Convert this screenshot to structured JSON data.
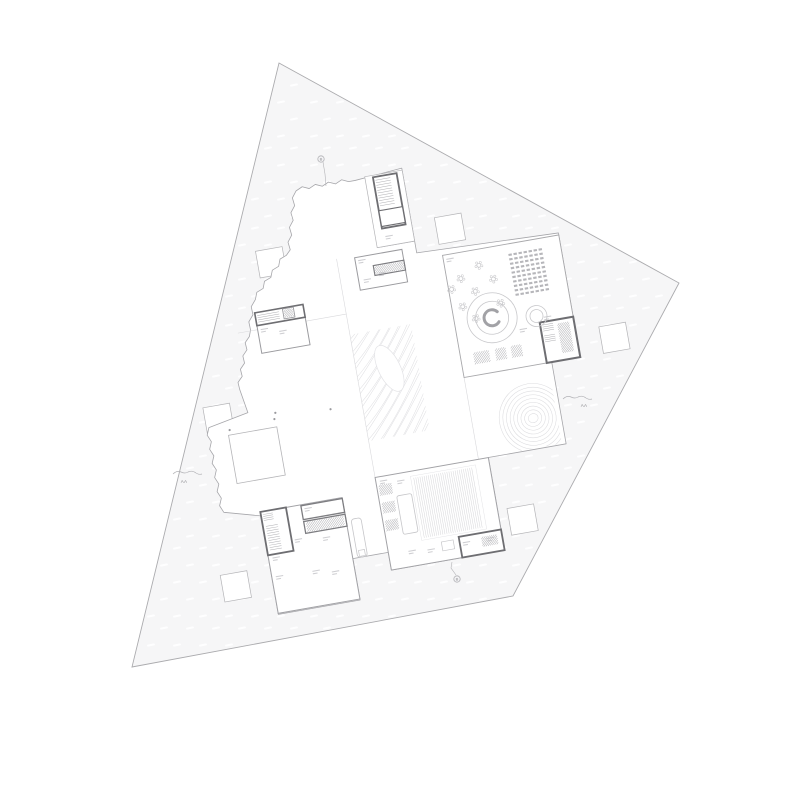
{
  "title": "architectural-floor-plan",
  "colors": {
    "background": "#ffffff",
    "white": "#ffffff",
    "site_fill": "#f6f6f7",
    "site_stroke": "#ababae",
    "envelope_stroke": "#a6a6aa",
    "dark": "#6e6e72",
    "dark2": "#7d7d81",
    "mid": "#9b9b9f",
    "mid2": "#a2a2a6",
    "light": "#b4b4b7",
    "light2": "#a8a8ab",
    "faint": "#d9d9dc",
    "line_mid": "#b5b5b8",
    "vfaint": "#e3e3e6",
    "furn": "#c6c6c9",
    "hatch": "#aeaeb2",
    "grain": "#e0e0e3",
    "contour": "#dcdcdf",
    "label_mark": "#c3c3c7",
    "marker_text": "#8f8f93",
    "marker_line": "#b2b2b6",
    "seat": "#b6b6ba",
    "hall_line": "#d3d3d6",
    "circle": "#c8c8cb",
    "arc": "#a2a2a6",
    "dot": "#9a9a9e"
  },
  "plan": {
    "site": {
      "points": [
        [
          279,
          63
        ],
        [
          679,
          283
        ],
        [
          513,
          596
        ],
        [
          132,
          667
        ]
      ]
    },
    "texture": {
      "x0": 95,
      "y0": 70,
      "x1": 715,
      "y1": 695,
      "dx": 27,
      "dy": 16,
      "w": 8,
      "h": 2.1
    },
    "rotation": {
      "angle": -10,
      "cx": 400,
      "cy": 400
    },
    "squares": {
      "size": 27,
      "centers": [
        [
          479,
          240
        ],
        [
          297,
          242
        ],
        [
          622,
          376
        ],
        [
          218,
          387
        ],
        [
          500,
          539
        ],
        [
          206,
          555
        ]
      ]
    },
    "envelope": {
      "points": [
        [
          334,
          176
        ],
        [
          394,
          176
        ],
        [
          442,
          172
        ],
        [
          442,
          258
        ],
        [
          585,
          263
        ],
        [
          585,
          389
        ],
        [
          556,
          389
        ],
        [
          556,
          472
        ],
        [
          477,
          472
        ],
        [
          477,
          566
        ],
        [
          362,
          566
        ],
        [
          362,
          548
        ],
        [
          326,
          548
        ],
        [
          326,
          590
        ],
        [
          243,
          590
        ],
        [
          243,
          490
        ],
        [
          207,
          480
        ],
        [
          207,
          394
        ],
        [
          248,
          386
        ],
        [
          244,
          362
        ],
        [
          265,
          305
        ],
        [
          275,
          276
        ],
        [
          318,
          233
        ]
      ],
      "jagged": [
        0,
        16,
        19,
        20,
        21,
        22
      ],
      "tooth": 7,
      "amp": 3
    },
    "lines": [
      [
        362,
        250,
        362,
        472,
        "faint",
        0.6
      ],
      [
        467,
        265,
        467,
        472,
        "faint",
        0.6
      ],
      [
        252,
        306,
        362,
        306,
        "faint",
        0.6
      ],
      [
        404,
        246,
        442,
        246,
        "mid",
        0.8
      ],
      [
        527,
        267,
        527,
        364,
        "faint",
        0.6
      ],
      [
        527,
        332,
        585,
        332,
        "faint",
        0.6
      ],
      [
        467,
        364,
        585,
        364,
        "mid",
        0.8
      ],
      [
        378,
        472,
        378,
        545,
        "mid",
        0.8
      ],
      [
        362,
        545,
        477,
        545,
        "mid",
        0.8
      ],
      [
        398,
        545,
        398,
        566,
        "faint",
        0.6
      ],
      [
        414,
        545,
        414,
        566,
        "faint",
        0.6
      ],
      [
        452,
        547,
        452,
        566,
        "dark",
        1.3
      ],
      [
        269,
        486,
        269,
        530,
        "mid",
        0.8
      ],
      [
        269,
        515,
        326,
        515,
        "dark",
        1.1
      ],
      [
        281,
        515,
        281,
        589,
        "faint",
        0.6
      ],
      [
        243,
        545,
        326,
        545,
        "mid",
        0.8
      ],
      [
        398,
        263,
        398,
        285,
        "faint",
        0.6
      ],
      [
        292,
        302,
        292,
        330,
        "faint",
        0.6
      ]
    ],
    "rects": [
      {
        "x": 404,
        "y": 174,
        "w": 38,
        "h": 72,
        "s": "light",
        "sw": 0.7,
        "n": "north-stair-wing"
      },
      {
        "x": 412,
        "y": 176,
        "w": 24,
        "h": 52,
        "s": "dark",
        "sw": 1.8,
        "n": "north-stair-core"
      },
      {
        "x": 412,
        "y": 210,
        "w": 24,
        "h": 16,
        "s": "dark",
        "sw": 1.1,
        "n": "north-stair-cell"
      },
      {
        "x": 380,
        "y": 252,
        "w": 48,
        "h": 33,
        "s": "mid",
        "sw": 1,
        "n": "upper-service-core"
      },
      {
        "x": 397,
        "y": 263,
        "w": 31,
        "h": 10,
        "s": "dark2",
        "sw": 1.2,
        "n": "upper-stair-run"
      },
      {
        "x": 272,
        "y": 289,
        "w": 49,
        "h": 41,
        "s": "mid",
        "sw": 1,
        "n": "west-block"
      },
      {
        "x": 272,
        "y": 289,
        "w": 49,
        "h": 13,
        "s": "dark",
        "sw": 1.6,
        "n": "west-stair-band"
      },
      {
        "x": 300,
        "y": 290,
        "w": 11,
        "h": 10,
        "s": "mid",
        "sw": 0.9,
        "n": "west-cell"
      },
      {
        "x": 467,
        "y": 265,
        "w": 118,
        "h": 124,
        "s": "light2",
        "sw": 0.9,
        "n": "kindergarten-block"
      },
      {
        "x": 551,
        "y": 348,
        "w": 34,
        "h": 41,
        "s": "dark",
        "sw": 2,
        "n": "east-service-core"
      },
      {
        "x": 362,
        "y": 472,
        "w": 115,
        "h": 94,
        "s": "mid2",
        "sw": 1,
        "n": "hall-block"
      },
      {
        "x": 397,
        "y": 477,
        "w": 66,
        "h": 65,
        "s": "vfaint",
        "sw": 0.5,
        "n": "hall-floor-area",
        "nf": 1
      },
      {
        "x": 380,
        "y": 494,
        "w": 15,
        "h": 39,
        "s": "furn",
        "sw": 0.8,
        "rx": 2,
        "n": "hall-stage-mat",
        "nf": 1
      },
      {
        "x": 434,
        "y": 545,
        "w": 43,
        "h": 21,
        "s": "dark",
        "sw": 1.8,
        "n": "hall-service-core"
      },
      {
        "x": 416,
        "y": 547,
        "w": 12,
        "h": 9,
        "s": "furn",
        "sw": 0.7,
        "n": "hall-furniture",
        "nf": 1
      },
      {
        "x": 243,
        "y": 486,
        "w": 83,
        "h": 103,
        "s": "mid2",
        "sw": 1,
        "n": "southwest-block"
      },
      {
        "x": 243,
        "y": 486,
        "w": 26,
        "h": 44,
        "s": "dark",
        "sw": 1.8,
        "n": "southwest-stair-core"
      },
      {
        "x": 284,
        "y": 487,
        "w": 42,
        "h": 14,
        "s": "dark2",
        "sw": 1.3,
        "n": "southwest-room"
      },
      {
        "x": 284,
        "y": 503,
        "w": 42,
        "h": 12,
        "s": "dark2",
        "sw": 1.3,
        "n": "southwest-stair-run"
      },
      {
        "x": 225,
        "y": 405,
        "w": 49,
        "h": 49,
        "s": "light",
        "sw": 0.8,
        "nf": 1,
        "n": "entry-courtyard-square"
      },
      {
        "x": 331,
        "y": 509,
        "w": 10,
        "h": 39,
        "s": "furn",
        "sw": 0.8,
        "rx": 3,
        "nf": 1,
        "n": "bench"
      },
      {
        "x": 333,
        "y": 541,
        "w": 6,
        "h": 6,
        "s": "furn",
        "sw": 0.7,
        "nf": 1,
        "n": "bench-end"
      }
    ],
    "hatches": [
      [
        414,
        178,
        15,
        28,
        "h",
        2.6
      ],
      [
        398,
        264,
        29,
        8,
        "d",
        2.2
      ],
      [
        274,
        291,
        22,
        9,
        "h",
        2.2
      ],
      [
        301,
        291,
        9,
        8,
        "d",
        2
      ],
      [
        480,
        366,
        16,
        12,
        "d",
        2.4
      ],
      [
        502,
        366,
        11,
        12,
        "d",
        2.4
      ],
      [
        518,
        366,
        11,
        12,
        "d",
        2.4
      ],
      [
        553,
        350,
        11,
        9,
        "h",
        2
      ],
      [
        553,
        361,
        11,
        9,
        "h",
        2
      ],
      [
        568,
        352,
        12,
        30,
        "d",
        2.2
      ],
      [
        364,
        480,
        13,
        11,
        "d",
        2.2
      ],
      [
        364,
        498,
        13,
        11,
        "d",
        2.2
      ],
      [
        364,
        516,
        13,
        11,
        "d",
        2.2
      ],
      [
        456,
        549,
        16,
        10,
        "d",
        2.2
      ],
      [
        245,
        488,
        10,
        8,
        "h",
        2
      ],
      [
        246,
        500,
        12,
        27,
        "h",
        2.4
      ],
      [
        286,
        504,
        38,
        10,
        "d",
        2.4
      ]
    ],
    "circles": [
      [
        505,
        335,
        25
      ],
      [
        505,
        335,
        16.5
      ],
      [
        549,
        341,
        10.5
      ],
      [
        549,
        341,
        6.5
      ]
    ],
    "arc": {
      "cx": 505,
      "cy": 335,
      "r": 8,
      "w": 3
    },
    "flowers": [
      [
        481,
        291
      ],
      [
        493,
        306
      ],
      [
        478,
        319
      ],
      [
        501,
        281
      ],
      [
        513,
        297
      ],
      [
        489,
        333
      ],
      [
        516,
        322
      ],
      [
        470,
        300
      ]
    ],
    "grid": {
      "x": 532,
      "y": 275,
      "cols": 7,
      "rows": 10,
      "cw": 3.4,
      "ch": 2.1,
      "sx": 5.1,
      "sy": 4.5
    },
    "vgroup": {
      "x": 400,
      "y": 479,
      "w": 60,
      "h": 61,
      "step": 2.1
    },
    "grain": {
      "x": 362,
      "y": 327,
      "w": 62,
      "h": 108,
      "step": 6.4,
      "island": {
        "cx": 33,
        "cy": 40,
        "rx": 11,
        "ry": 25,
        "rot": -16
      }
    },
    "mound": {
      "x": 491,
      "y": 401,
      "w": 61,
      "h": 70,
      "cx": 37,
      "cy": 40,
      "rings": 9,
      "rx0": 5,
      "ry0": 4.5,
      "dr": 3.6
    },
    "dots": [
      [
        227,
        400
      ],
      [
        273,
        397
      ],
      [
        275,
        391
      ],
      [
        330,
        397
      ]
    ],
    "micro": [
      [
        414,
        236
      ],
      [
        383,
        255
      ],
      [
        401,
        271
      ],
      [
        275,
        306
      ],
      [
        293,
        311
      ],
      [
        470,
        269
      ],
      [
        530,
        351
      ],
      [
        556,
        343
      ],
      [
        366,
        476
      ],
      [
        383,
        479
      ],
      [
        382,
        550
      ],
      [
        401,
        552
      ],
      [
        437,
        551
      ],
      [
        287,
        490
      ],
      [
        272,
        519
      ],
      [
        300,
        522
      ],
      [
        247,
        552
      ],
      [
        284,
        553
      ],
      [
        303,
        557
      ],
      [
        247,
        533
      ],
      [
        461,
        551
      ],
      [
        385,
        275
      ]
    ],
    "markers": [
      {
        "kind": "flag",
        "cx": 321,
        "cy": 159,
        "r": 3.2,
        "label": "B",
        "leader": [
          [
            323,
            162
          ],
          [
            325,
            174
          ],
          [
            326,
            186
          ]
        ]
      },
      {
        "kind": "flag",
        "cx": 457,
        "cy": 579,
        "r": 3.2,
        "label": "B",
        "leader": [
          [
            456,
            575
          ],
          [
            451,
            568
          ],
          [
            452,
            562
          ]
        ]
      },
      {
        "kind": "squiggle",
        "x": 563,
        "y": 399,
        "label": "AA",
        "tx": 584,
        "ty": 407
      },
      {
        "kind": "squiggle",
        "x": 173,
        "y": 474,
        "label": "AA",
        "tx": 184,
        "ty": 483
      }
    ]
  }
}
